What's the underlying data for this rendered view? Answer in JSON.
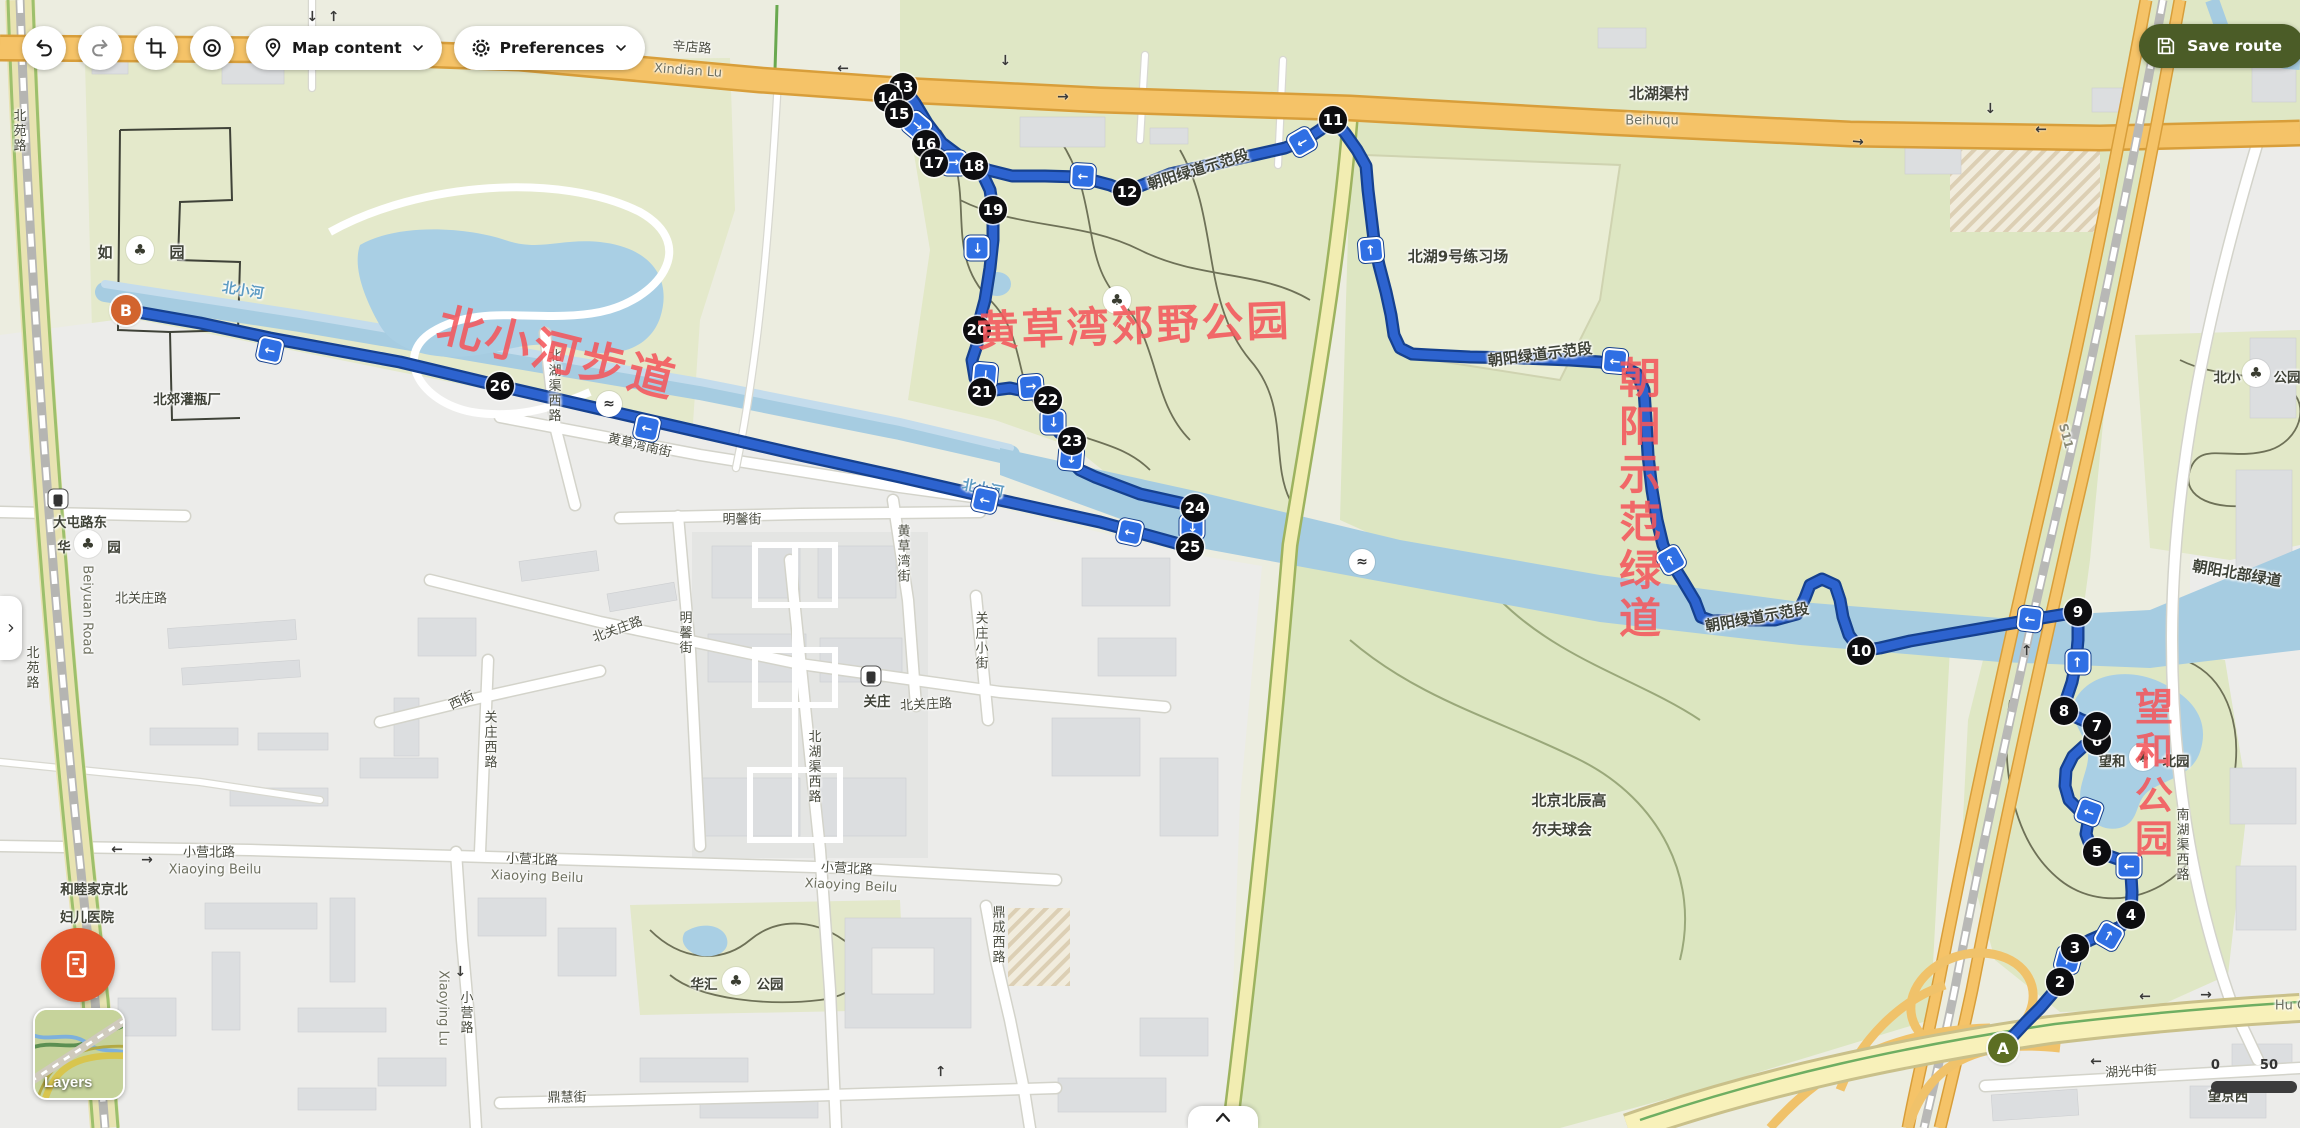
{
  "toolbar": {
    "map_content": "Map content",
    "preferences": "Preferences",
    "save_route": "Save route"
  },
  "panel": {
    "layers": "Layers"
  },
  "scalebar": {
    "start": "0",
    "end": "50"
  },
  "route": {
    "start": "A",
    "end": "B",
    "color": "#2d63cf",
    "waypoints": [
      {
        "n": "2",
        "x": 2060,
        "y": 982
      },
      {
        "n": "3",
        "x": 2075,
        "y": 948
      },
      {
        "n": "4",
        "x": 2131,
        "y": 915
      },
      {
        "n": "5",
        "x": 2097,
        "y": 852
      },
      {
        "n": "6",
        "x": 2097,
        "y": 741
      },
      {
        "n": "7",
        "x": 2097,
        "y": 726
      },
      {
        "n": "8",
        "x": 2064,
        "y": 711
      },
      {
        "n": "9",
        "x": 2078,
        "y": 612
      },
      {
        "n": "10",
        "x": 1861,
        "y": 651
      },
      {
        "n": "11",
        "x": 1333,
        "y": 120
      },
      {
        "n": "12",
        "x": 1127,
        "y": 192
      },
      {
        "n": "13",
        "x": 903,
        "y": 87
      },
      {
        "n": "14",
        "x": 888,
        "y": 98
      },
      {
        "n": "15",
        "x": 899,
        "y": 114
      },
      {
        "n": "16",
        "x": 926,
        "y": 144
      },
      {
        "n": "17",
        "x": 934,
        "y": 163
      },
      {
        "n": "18",
        "x": 974,
        "y": 166
      },
      {
        "n": "19",
        "x": 993,
        "y": 210
      },
      {
        "n": "20",
        "x": 977,
        "y": 330
      },
      {
        "n": "21",
        "x": 982,
        "y": 392
      },
      {
        "n": "22",
        "x": 1048,
        "y": 400
      },
      {
        "n": "23",
        "x": 1072,
        "y": 441
      },
      {
        "n": "24",
        "x": 1195,
        "y": 508
      },
      {
        "n": "25",
        "x": 1190,
        "y": 547
      },
      {
        "n": "26",
        "x": 500,
        "y": 386
      }
    ],
    "arrows": [
      {
        "x": 270,
        "y": 350,
        "r": 192
      },
      {
        "x": 647,
        "y": 428,
        "r": 192
      },
      {
        "x": 985,
        "y": 500,
        "r": 192
      },
      {
        "x": 1130,
        "y": 532,
        "r": 192
      },
      {
        "x": 985,
        "y": 375,
        "r": 95
      },
      {
        "x": 1031,
        "y": 387,
        "r": -5
      },
      {
        "x": 1053,
        "y": 422,
        "r": 90
      },
      {
        "x": 1071,
        "y": 458,
        "r": 95
      },
      {
        "x": 1192,
        "y": 527,
        "r": 90
      },
      {
        "x": 917,
        "y": 126,
        "r": 40
      },
      {
        "x": 954,
        "y": 163,
        "r": 0
      },
      {
        "x": 1083,
        "y": 176,
        "r": 183
      },
      {
        "x": 977,
        "y": 248,
        "r": 90
      },
      {
        "x": 1302,
        "y": 142,
        "r": 150
      },
      {
        "x": 1371,
        "y": 250,
        "r": -95
      },
      {
        "x": 1615,
        "y": 361,
        "r": 185
      },
      {
        "x": 1671,
        "y": 560,
        "r": -120
      },
      {
        "x": 2030,
        "y": 619,
        "r": 187
      },
      {
        "x": 2078,
        "y": 662,
        "r": -90
      },
      {
        "x": 2089,
        "y": 812,
        "r": -160
      },
      {
        "x": 2129,
        "y": 866,
        "r": 180
      },
      {
        "x": 2109,
        "y": 936,
        "r": -60
      },
      {
        "x": 2068,
        "y": 960,
        "r": -75
      }
    ]
  },
  "annotations": [
    {
      "t": "北小河步道",
      "x": 558,
      "y": 350,
      "r": 14,
      "s": 46
    },
    {
      "t": "黄草湾郊野公园",
      "x": 1134,
      "y": 323,
      "r": -2,
      "s": 42
    },
    {
      "t": "朝阳示范绿道",
      "x": 1637,
      "y": 500,
      "s": 42,
      "v": 1
    },
    {
      "t": "望和公园",
      "x": 2151,
      "y": 775,
      "s": 38,
      "v": 1
    }
  ],
  "map_labels": [
    {
      "t": "辛店路",
      "x": 692,
      "y": 46,
      "r": 4,
      "c": "road"
    },
    {
      "t": "Xindian Lu",
      "x": 688,
      "y": 71,
      "r": 4,
      "c": "pin"
    },
    {
      "t": "北湖渠村",
      "x": 1659,
      "y": 93,
      "c": "place"
    },
    {
      "t": "Beihuqu",
      "x": 1652,
      "y": 121,
      "c": "pin"
    },
    {
      "t": "北湖9号练习场",
      "x": 1458,
      "y": 256,
      "c": "place"
    },
    {
      "t": "朝阳绿道示范段",
      "x": 1198,
      "y": 169,
      "r": -17,
      "c": "route"
    },
    {
      "t": "朝阳绿道示范段",
      "x": 1540,
      "y": 354,
      "r": -7,
      "c": "route"
    },
    {
      "t": "朝阳绿道示范段",
      "x": 1757,
      "y": 617,
      "r": -10,
      "c": "route"
    },
    {
      "t": "朝阳北部绿道",
      "x": 2237,
      "y": 573,
      "r": 10,
      "c": "route"
    },
    {
      "t": "北小河",
      "x": 243,
      "y": 290,
      "r": 9,
      "c": "water"
    },
    {
      "t": "北小河",
      "x": 983,
      "y": 488,
      "r": 11,
      "c": "water"
    },
    {
      "t": "北郊灌瓶厂",
      "x": 187,
      "y": 398,
      "c": "sm"
    },
    {
      "t": "大屯路东",
      "x": 80,
      "y": 521,
      "c": "sm"
    },
    {
      "t": "S11",
      "x": 2066,
      "y": 436,
      "r": 75,
      "c": "hw"
    },
    {
      "t": "北关庄路",
      "x": 926,
      "y": 703,
      "r": -3,
      "c": "road"
    },
    {
      "t": "北关庄路",
      "x": 617,
      "y": 628,
      "r": -20,
      "c": "road"
    },
    {
      "t": "北关庄路",
      "x": 141,
      "y": 597,
      "c": "road"
    },
    {
      "t": "关庄",
      "x": 877,
      "y": 700,
      "c": "sm"
    },
    {
      "t": "关庄西路",
      "x": 489,
      "y": 740,
      "v": 1,
      "c": "road"
    },
    {
      "t": "西街",
      "x": 461,
      "y": 699,
      "r": -25,
      "c": "road"
    },
    {
      "t": "明馨街",
      "x": 742,
      "y": 518,
      "c": "road"
    },
    {
      "t": "明馨街",
      "x": 684,
      "y": 633,
      "v": 1,
      "c": "road"
    },
    {
      "t": "关庄小街",
      "x": 980,
      "y": 641,
      "v": 1,
      "c": "road"
    },
    {
      "t": "北湖渠西路",
      "x": 813,
      "y": 767,
      "v": 1,
      "c": "road"
    },
    {
      "t": "北湖渠西路",
      "x": 553,
      "y": 386,
      "v": 1,
      "c": "road"
    },
    {
      "t": "黄草湾南街",
      "x": 640,
      "y": 444,
      "r": 13,
      "c": "road"
    },
    {
      "t": "黄草湾街",
      "x": 902,
      "y": 554,
      "v": 1,
      "c": "road"
    },
    {
      "t": "小营北路",
      "x": 209,
      "y": 851,
      "c": "road"
    },
    {
      "t": "Xiaoying Beilu",
      "x": 215,
      "y": 870,
      "c": "pin"
    },
    {
      "t": "小营北路",
      "x": 532,
      "y": 858,
      "r": 2,
      "c": "road"
    },
    {
      "t": "Xiaoying Beilu",
      "x": 537,
      "y": 877,
      "r": 2,
      "c": "pin"
    },
    {
      "t": "小营北路",
      "x": 847,
      "y": 867,
      "r": 3,
      "c": "road"
    },
    {
      "t": "Xiaoying Beilu",
      "x": 851,
      "y": 886,
      "r": 3,
      "c": "pin"
    },
    {
      "t": "小营路",
      "x": 465,
      "y": 1013,
      "v": 1,
      "c": "road"
    },
    {
      "t": "Xiaoying Lu",
      "x": 443,
      "y": 1008,
      "r": 90,
      "c": "pin"
    },
    {
      "t": "鼎慧街",
      "x": 567,
      "y": 1096,
      "c": "road"
    },
    {
      "t": "鼎成西路",
      "x": 997,
      "y": 935,
      "v": 1,
      "c": "road"
    },
    {
      "t": "和睦家京北",
      "x": 94,
      "y": 888,
      "c": "sm"
    },
    {
      "t": "妇儿医院",
      "x": 87,
      "y": 916,
      "c": "sm"
    },
    {
      "t": "湖光中街",
      "x": 2131,
      "y": 1070,
      "r": -3,
      "c": "road"
    },
    {
      "t": "Hu G",
      "x": 2291,
      "y": 1006,
      "c": "pin"
    },
    {
      "t": "望京西",
      "x": 2228,
      "y": 1095,
      "c": "sm"
    },
    {
      "t": "南湖渠西路",
      "x": 2181,
      "y": 845,
      "v": 1,
      "c": "road"
    },
    {
      "t": "北京北辰高",
      "x": 1569,
      "y": 800,
      "c": "place"
    },
    {
      "t": "尔夫球会",
      "x": 1562,
      "y": 829,
      "c": "place"
    },
    {
      "t": "北苑路",
      "x": 18,
      "y": 131,
      "v": 1,
      "c": "road"
    },
    {
      "t": "北苑路",
      "x": 31,
      "y": 668,
      "v": 1,
      "c": "road"
    },
    {
      "t": "Beiyuan Road",
      "x": 87,
      "y": 610,
      "r": 90,
      "c": "pin"
    },
    {
      "t": "如",
      "x": 105,
      "y": 252,
      "c": "place"
    },
    {
      "t": "园",
      "x": 177,
      "y": 252,
      "c": "place"
    },
    {
      "t": "华",
      "x": 64,
      "y": 546,
      "c": "sm"
    },
    {
      "t": "园",
      "x": 114,
      "y": 546,
      "c": "sm"
    },
    {
      "t": "华汇",
      "x": 704,
      "y": 983,
      "c": "sm"
    },
    {
      "t": "公园",
      "x": 770,
      "y": 983,
      "c": "sm"
    },
    {
      "t": "望和",
      "x": 2112,
      "y": 760,
      "c": "sm"
    },
    {
      "t": "北园",
      "x": 2176,
      "y": 760,
      "c": "sm"
    },
    {
      "t": "北小",
      "x": 2227,
      "y": 376,
      "c": "sm"
    },
    {
      "t": "公园",
      "x": 2287,
      "y": 376,
      "c": "sm"
    }
  ],
  "park_icons": [
    {
      "x": 140,
      "y": 250
    },
    {
      "x": 88,
      "y": 544
    },
    {
      "x": 736,
      "y": 981
    },
    {
      "x": 2143,
      "y": 757
    },
    {
      "x": 2256,
      "y": 373
    },
    {
      "x": 1117,
      "y": 300
    }
  ],
  "metro_icons": [
    {
      "x": 871,
      "y": 676
    },
    {
      "x": 58,
      "y": 499
    }
  ],
  "ferry_icons": [
    {
      "x": 609,
      "y": 404
    },
    {
      "x": 1362,
      "y": 562
    }
  ],
  "road_arrows": [
    {
      "x": 843,
      "y": 68,
      "r": 180
    },
    {
      "x": 1858,
      "y": 142,
      "r": 5
    },
    {
      "x": 2041,
      "y": 129,
      "r": 180
    },
    {
      "x": 312,
      "y": 16,
      "r": 90
    },
    {
      "x": 334,
      "y": 16,
      "r": -90
    },
    {
      "x": 117,
      "y": 849,
      "r": 180
    },
    {
      "x": 147,
      "y": 860,
      "r": 0
    },
    {
      "x": 2206,
      "y": 995,
      "r": 0
    },
    {
      "x": 2145,
      "y": 996,
      "r": 180
    },
    {
      "x": 2096,
      "y": 1061,
      "r": 180
    },
    {
      "x": 2027,
      "y": 650,
      "r": -90
    },
    {
      "x": 941,
      "y": 1071,
      "r": -90
    },
    {
      "x": 460,
      "y": 971,
      "r": 90
    },
    {
      "x": 1990,
      "y": 108,
      "r": 90
    },
    {
      "x": 1005,
      "y": 60,
      "r": 90
    },
    {
      "x": 1063,
      "y": 97,
      "r": 0
    }
  ]
}
